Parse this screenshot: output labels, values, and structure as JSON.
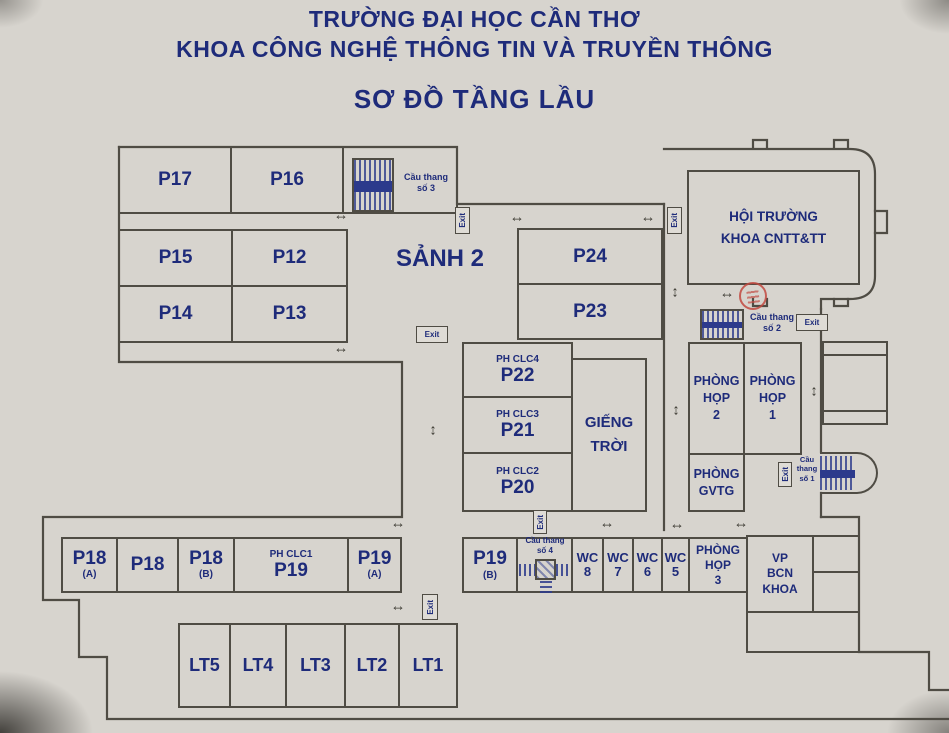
{
  "title": {
    "line1": "TRƯỜNG ĐẠI HỌC CẦN THƠ",
    "line2": "KHOA CÔNG NGHỆ THÔNG TIN VÀ TRUYỀN THÔNG",
    "line3": "SƠ ĐỒ TẦNG LẦU"
  },
  "labels": {
    "exit": "Exit",
    "sanh2": "SẢNH 2",
    "gieng_troi": "GIẾNG\nTRỜI",
    "hoi_truong": "HỘI TRƯỜNG\nKHOA CNTT&TT"
  },
  "rooms": {
    "p17": "P17",
    "p16": "P16",
    "p15": "P15",
    "p12": "P12",
    "p14": "P14",
    "p13": "P13",
    "p24": "P24",
    "p23": "P23",
    "p22": "P22",
    "p22_sub": "PH CLC4",
    "p21": "P21",
    "p21_sub": "PH CLC3",
    "p20": "P20",
    "p20_sub": "PH CLC2",
    "hop2": "PHÒNG\nHỌP\n2",
    "hop1": "PHÒNG\nHỌP\n1",
    "gvtg": "PHÒNG\nGVTG",
    "p18a": "P18",
    "p18a_sub": "(A)",
    "p18": "P18",
    "p18b": "P18",
    "p18b_sub": "(B)",
    "p19": "P19",
    "p19_sub": "PH CLC1",
    "p19a": "P19",
    "p19a_sub": "(A)",
    "p19b": "P19",
    "p19b_sub": "(B)",
    "wc": "WC",
    "wc8": "8",
    "wc7": "7",
    "wc6": "6",
    "wc5": "5",
    "hop3": "PHÒNG\nHỌP\n3",
    "vp_bcn": "VP\nBCN\nKHOA",
    "lt5": "LT5",
    "lt4": "LT4",
    "lt3": "LT3",
    "lt2": "LT2",
    "lt1": "LT1"
  },
  "stairs": {
    "s3": "Cầu thang\nsố 3",
    "s2": "Cầu thang\nsố 2",
    "s1": "Cầu\nthang\nsố 1",
    "s4": "Cầu thang\nsố 4"
  },
  "icons": {
    "h_arrow": "↔",
    "v_arrow": "↕"
  },
  "colors": {
    "paper": "#d7d4ce",
    "wall": "#4f4c44",
    "label": "#1e2b7a",
    "stair": "#2c3a8c",
    "stamp": "#c24a41"
  }
}
